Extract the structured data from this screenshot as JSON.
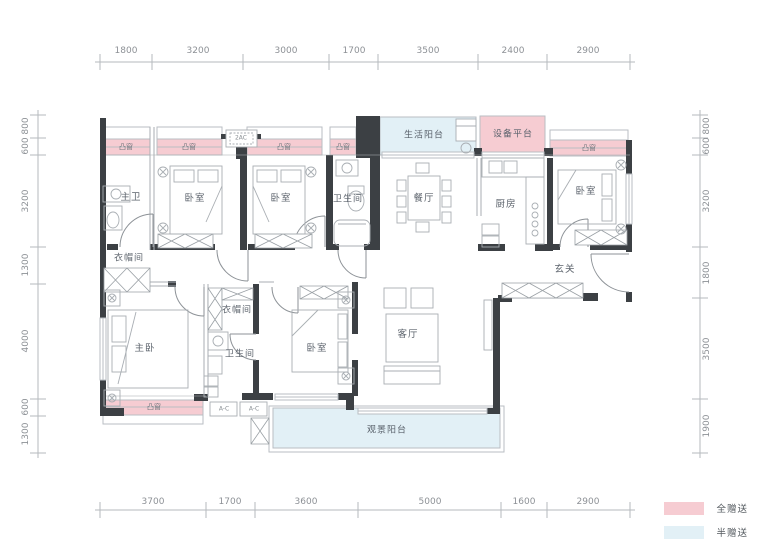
{
  "rulers": {
    "top": [
      "1800",
      "3200",
      "3000",
      "1700",
      "3500",
      "2400",
      "2900"
    ],
    "bottom": [
      "3700",
      "1700",
      "3600",
      "5000",
      "1600",
      "2900"
    ],
    "left": [
      "800",
      "600",
      "3200",
      "1300",
      "4000",
      "600",
      "1300"
    ],
    "right": [
      "800",
      "600",
      "3200",
      "1800",
      "3500",
      "1900"
    ]
  },
  "rooms": {
    "master_bath": "主卫",
    "bedroom_a": "卧室",
    "bedroom_b": "卧室",
    "bath_top": "卫生间",
    "dining": "餐厅",
    "kitchen": "厨房",
    "bedroom_c": "卧室",
    "cloakroom_a": "衣帽间",
    "entry": "玄关",
    "master_bedroom": "主卧",
    "cloakroom_b": "衣帽间",
    "bath_b": "卫生间",
    "bedroom_d": "卧室",
    "living": "客厅",
    "life_balcony": "生活阳台",
    "equipment_platform": "设备平台",
    "view_balcony": "观景阳台"
  },
  "annotations": {
    "bay_window": "凸窗",
    "ac_top": "2AC",
    "ac_unit": "A-C"
  },
  "legend": {
    "full_gift": {
      "label": "全赠送",
      "color": "#f6ccd2"
    },
    "half_gift": {
      "label": "半赠送",
      "color": "#e2f0f6"
    }
  },
  "colors": {
    "gift_pink": "#f6ccd2",
    "gift_blue": "#e2f0f6",
    "wall_dark": "#3c4044",
    "line_gray": "#a9aeb3"
  }
}
